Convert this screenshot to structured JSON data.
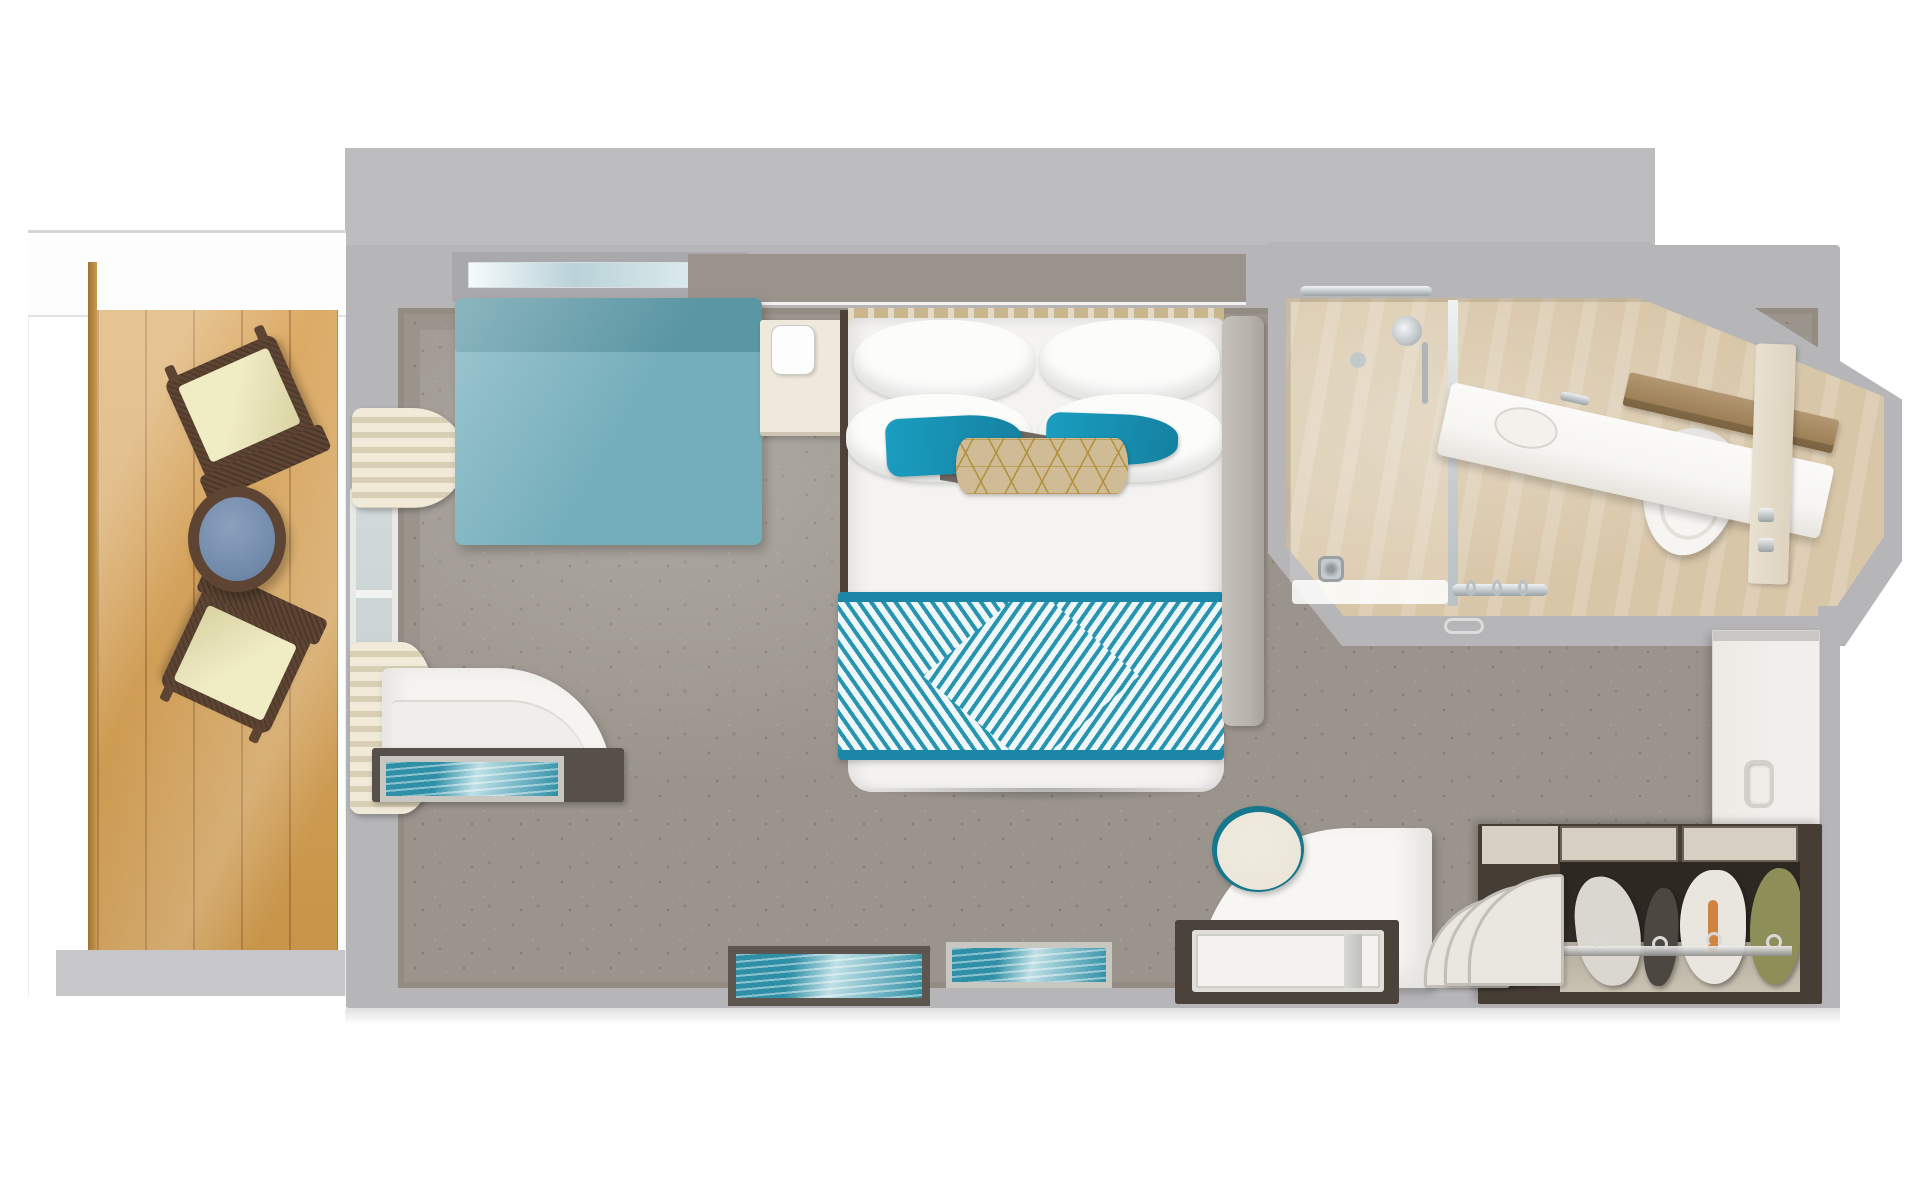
{
  "meta": {
    "title": "Cruise-ship balcony stateroom floor plan",
    "view": "top-down 3D rendered floor plan",
    "visible_text": "none"
  },
  "palette": {
    "page_bg": "#ffffff",
    "backdrop": "#bdbcbe",
    "wall": "#b6b5b7",
    "wall_edge": "#948c83",
    "carpet": "#9b948d",
    "carpet_speckle": "#857d75",
    "wood_light": "#d8a75f",
    "wood_dark": "#c79449",
    "rail": "#c89a52",
    "balcony_floor": "#c7c7c9",
    "wicker": "#5e4533",
    "cushion": "#eae5bd",
    "table_blue": "#7089a9",
    "window_glass": "#d3dadb",
    "curtain_cream": "#f1ead8",
    "curtain_shade": "#d8cfb5",
    "sofa": "#74aebb",
    "sofa_dark": "#5a96a3",
    "nightstand_cream": "#efe9dc",
    "trim_dark": "#5a4f45",
    "headboard_tan": "#c9b68d",
    "bedding_white": "#f4f3f1",
    "bedrail": "#b9b4ae",
    "teal_accent": "#1a9ec0",
    "gold": "#cfbc96",
    "runner_teal": "#1b86a5",
    "runner_stripe": "#2795b2",
    "bath_floor": "#d8c6a8",
    "counter_white": "#f6f5f2",
    "wood_shelf": "#b29772",
    "chrome": "#c7ccce",
    "door_beige": "#e9e1d1",
    "wardrobe_white": "#f1efeb",
    "closet_frame": "#463d35",
    "closet_interior": "#2e2823",
    "closet_floor": "#c9c1b2",
    "closet_top": "#d8d1c3",
    "garment_white": "#dad7d0",
    "garment_dark": "#4c4740",
    "garment_olive": "#8e8f58",
    "desk_dark": "#4a423b",
    "tray_white": "#f3f2ef",
    "stool_cream": "#ebe6d9",
    "stool_rim": "#15768c",
    "art_teal": "#2e8fa6",
    "art_teal_light": "#bfe0e6",
    "frame_dark": "#5d564f",
    "frame_silver": "#c9c7c2"
  },
  "rooms": {
    "balcony": {
      "name": "balcony",
      "floor": "light oak wood planks",
      "items": [
        {
          "name": "deck-chair",
          "count": 2,
          "material": "dark wicker frame",
          "cushion": "cream"
        },
        {
          "name": "side-table",
          "shape": "round",
          "top": "blue",
          "frame": "wicker"
        },
        {
          "name": "railing",
          "color": "tan wood"
        }
      ]
    },
    "bedroom": {
      "name": "stateroom bedroom",
      "floor": "gray patterned carpet",
      "items": [
        {
          "name": "sofa",
          "color": "teal"
        },
        {
          "name": "wall-shelf-with-glassware"
        },
        {
          "name": "curtains",
          "color": "cream",
          "count": 2
        },
        {
          "name": "window-balcony-door"
        },
        {
          "name": "nightstand",
          "count": 2
        },
        {
          "name": "table-lamp",
          "color": "white"
        },
        {
          "name": "bed",
          "bedding": "white duvet",
          "pillows": {
            "white": 4,
            "teal_accent": 2,
            "gold_lumbar": 1
          },
          "runner": "teal and white chevron-diamond pattern"
        },
        {
          "name": "desk-with-white-tray"
        },
        {
          "name": "curved-chair-panel",
          "color": "white"
        },
        {
          "name": "stool",
          "seat": "cream",
          "rim": "teal"
        },
        {
          "name": "curved-shelf-rack",
          "panels": 3
        },
        {
          "name": "curved-vanity-desk",
          "color": "white"
        },
        {
          "name": "framed-artwork",
          "count": 3,
          "image": "teal ocean"
        },
        {
          "name": "wardrobe-cabinet",
          "color": "white",
          "handle": "recessed"
        },
        {
          "name": "open-closet",
          "contents": "4 garments on chrome rail",
          "garment_colors": [
            "gray-white",
            "dark gray",
            "white with orange strap",
            "olive"
          ]
        }
      ]
    },
    "bathroom": {
      "name": "bathroom",
      "floor": "beige marble tile",
      "shape": "angled walls, bay toward upper right",
      "items": [
        {
          "name": "shower",
          "door": "glass",
          "fixtures": "chrome",
          "drain": "chrome"
        },
        {
          "name": "towel-rail",
          "rings": 3
        },
        {
          "name": "sink-vanity",
          "counter": "white",
          "faucet": "chrome"
        },
        {
          "name": "wood-ledge-shelf"
        },
        {
          "name": "toilet",
          "color": "white"
        },
        {
          "name": "door",
          "color": "beige",
          "hinges": "chrome"
        }
      ]
    }
  }
}
